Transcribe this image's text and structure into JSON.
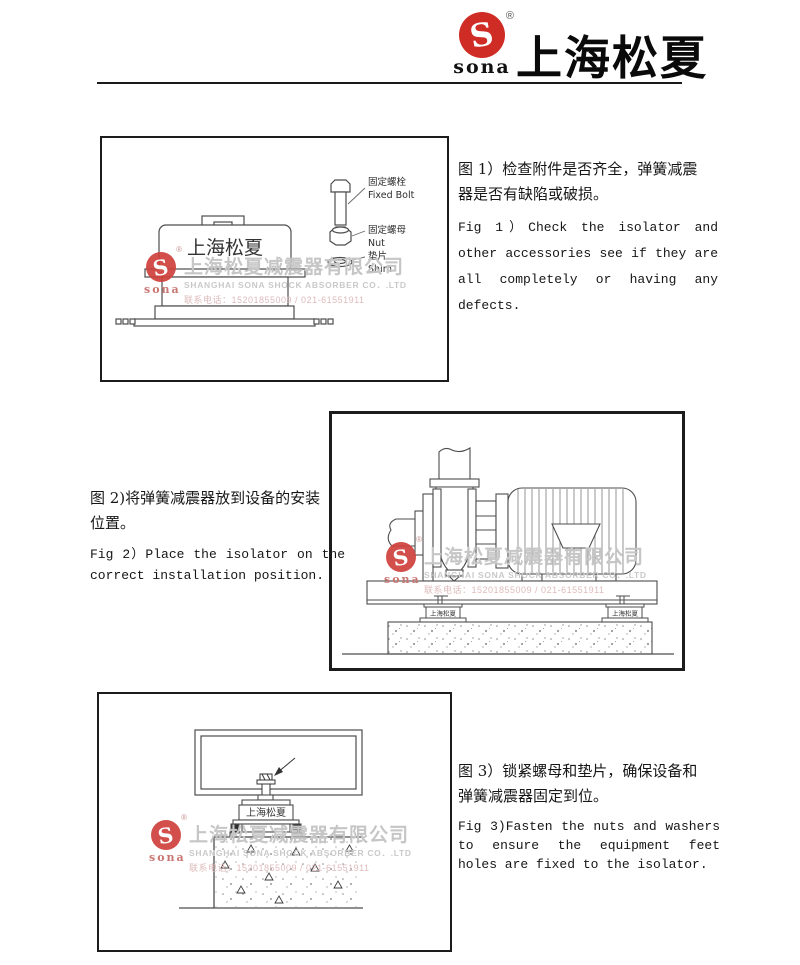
{
  "header": {
    "brand_zh": "上海松夏",
    "logo_text": "sona",
    "registered_mark": "®"
  },
  "watermark": {
    "logo_text": "sona",
    "registered_mark": "®",
    "company_zh": "上海松夏减震器有限公司",
    "company_en": "SHANGHAI SONA SHOCK ABSORBER CO．.LTD",
    "contact": "联系电话：15201855009 / 021-61551911"
  },
  "figure1": {
    "isolator_label": "上海松夏",
    "labels": {
      "bolt_zh": "固定螺栓",
      "bolt_en": "Fixed Bolt",
      "nut_zh": "固定螺母",
      "nut_en": "Nut",
      "shim_zh": "垫片",
      "shim_en": "Shim"
    },
    "caption_zh_lines": [
      "图 1）检查附件是否齐全，弹簧减震",
      "器是否有缺陷或破损。"
    ],
    "caption_en_lines": [
      "Fig 1）Check the isolator and",
      "other accessories see if they are",
      "all completely or having any",
      "defects."
    ]
  },
  "figure2": {
    "isolator_label": "上海松夏",
    "caption_zh_lines": [
      "图 2)将弹簧减震器放到设备的安装",
      "位置。"
    ],
    "caption_en_lines": [
      "Fig 2）Place the isolator on the",
      "correct installation position."
    ]
  },
  "figure3": {
    "isolator_label": "上海松夏",
    "caption_zh_lines": [
      "图 3）锁紧螺母和垫片，确保设备和",
      "弹簧减震器固定到位。"
    ],
    "caption_en_lines": [
      "Fig 3)Fasten the nuts and washers",
      "to ensure the equipment feet",
      "holes are fixed to the isolator."
    ]
  },
  "colors": {
    "brand_red": "#cf2c26",
    "drawing_line": "#4d4d4d",
    "watermark_gray": "#c6c6c6",
    "watermark_pink": "#debbba",
    "text": "#161616"
  }
}
